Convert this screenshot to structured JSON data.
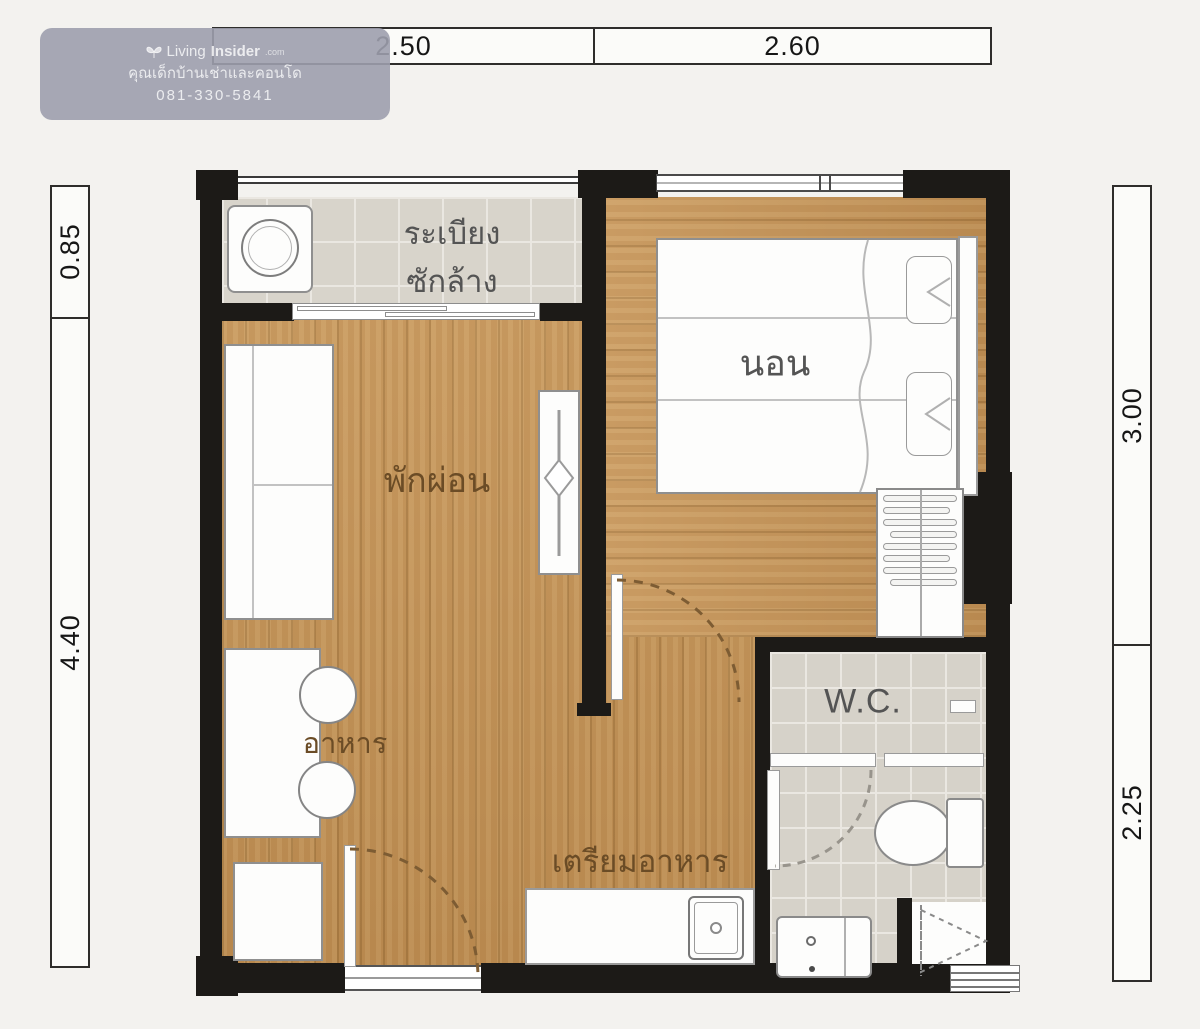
{
  "watermark": {
    "logo_icon": "butterfly-logo",
    "logo_text_light": "Living",
    "logo_text_bold": "Insider",
    "logo_suffix": ".com",
    "tagline": "คุณเด็กบ้านเช่าและคอนโด",
    "phone": "081-330-5841"
  },
  "dimensions": {
    "top": [
      {
        "label": "2.50"
      },
      {
        "label": "2.60"
      }
    ],
    "left": [
      {
        "label": "0.85"
      },
      {
        "label": "4.40"
      }
    ],
    "right": [
      {
        "label": "3.00"
      },
      {
        "label": "2.25"
      }
    ]
  },
  "rooms": {
    "balcony": {
      "label_line1": "ระเบียง",
      "label_line2": "ซักล้าง"
    },
    "living": {
      "label": "พักผ่อน"
    },
    "bedroom": {
      "label": "นอน"
    },
    "dining": {
      "label": "อาหาร"
    },
    "kitchen": {
      "label": "เตรียมอาหาร"
    },
    "wc": {
      "label": "W.C."
    }
  },
  "colors": {
    "wall": "#1c1a17",
    "wood_floor": "#c29155",
    "tile_floor": "#d8d4cb",
    "furniture_fill": "#fdfdfc",
    "furniture_outline": "#8f8f8f",
    "label_brown": "#6b4c26",
    "label_gray": "#545454",
    "dimension_text": "#161616",
    "watermark_bg": "#9d9ead",
    "door_swing": "#7d5c33"
  }
}
